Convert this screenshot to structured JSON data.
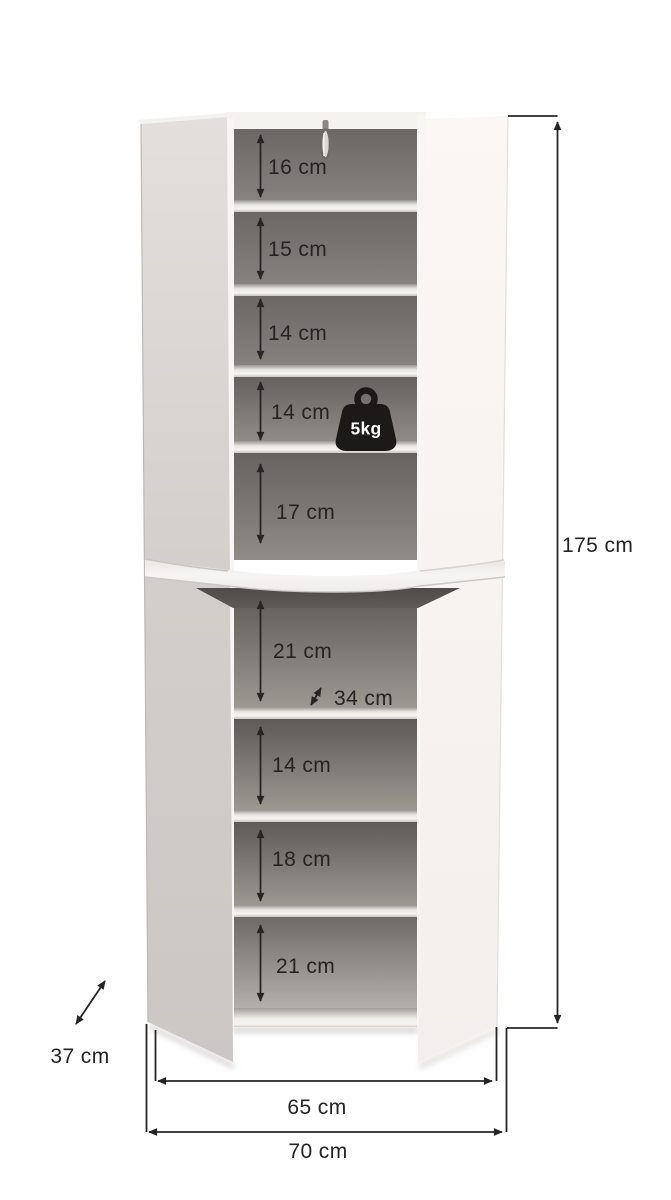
{
  "diagram": {
    "type": "furniture-dimension-diagram",
    "subject": "tall two-door storage cabinet with nine open compartments, doors shown open",
    "unit": "cm"
  },
  "dimensions": {
    "total_height": "175 cm",
    "total_width": "70 cm",
    "inner_width": "65 cm",
    "cabinet_depth": "37 cm",
    "shelf_depth": "34 cm",
    "upper_compartments": [
      "16 cm",
      "15 cm",
      "14 cm",
      "14 cm",
      "17 cm"
    ],
    "lower_compartments": [
      "21 cm",
      "14 cm",
      "18 cm",
      "21 cm"
    ]
  },
  "badges": {
    "max_shelf_load": "5kg"
  },
  "icons": {
    "weight": "weight-icon",
    "key": "key-icon"
  },
  "colors": {
    "background": "#ffffff",
    "dimension_line": "#262524",
    "interior_dark": "#6b6764",
    "door_white": "#f8f5f2",
    "door_gray": "#d5d1ce",
    "shelf_light": "#f4f2ef",
    "weight_badge": "#1c1a19"
  }
}
